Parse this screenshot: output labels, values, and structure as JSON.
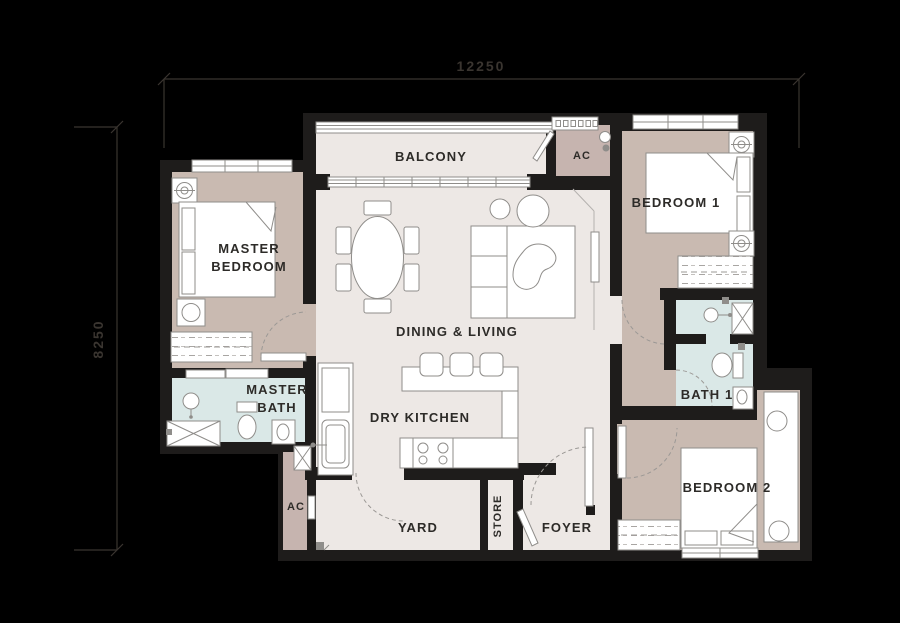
{
  "dimensions": {
    "top": "12250",
    "left": "8250"
  },
  "rooms": {
    "balcony": {
      "label": "BALCONY"
    },
    "ac_top": {
      "label": "AC"
    },
    "bedroom1": {
      "label": "BEDROOM 1"
    },
    "master_bedroom": {
      "line1": "MASTER",
      "line2": "BEDROOM"
    },
    "dining_living": {
      "label": "DINING & LIVING"
    },
    "dry_kitchen": {
      "label": "DRY KITCHEN"
    },
    "master_bath": {
      "line1": "MASTER",
      "line2": "BATH"
    },
    "bath1": {
      "label": "BATH 1"
    },
    "bedroom2": {
      "label": "BEDROOM 2"
    },
    "ac_bottom": {
      "label": "AC"
    },
    "yard": {
      "label": "YARD"
    },
    "store": {
      "label": "STORE"
    },
    "foyer": {
      "label": "FOYER"
    }
  },
  "colors": {
    "background": "#000000",
    "wall": "#1E1C1B",
    "floor_main": "#EDE8E5",
    "floor_bedroom": "#C9BAB1",
    "floor_bath": "#DAE8E7",
    "floor_ac": "#C6B4AF",
    "furniture_stroke": "#8F8D8A",
    "annotation": "#3A3530",
    "label_text": "#2D2B28"
  }
}
